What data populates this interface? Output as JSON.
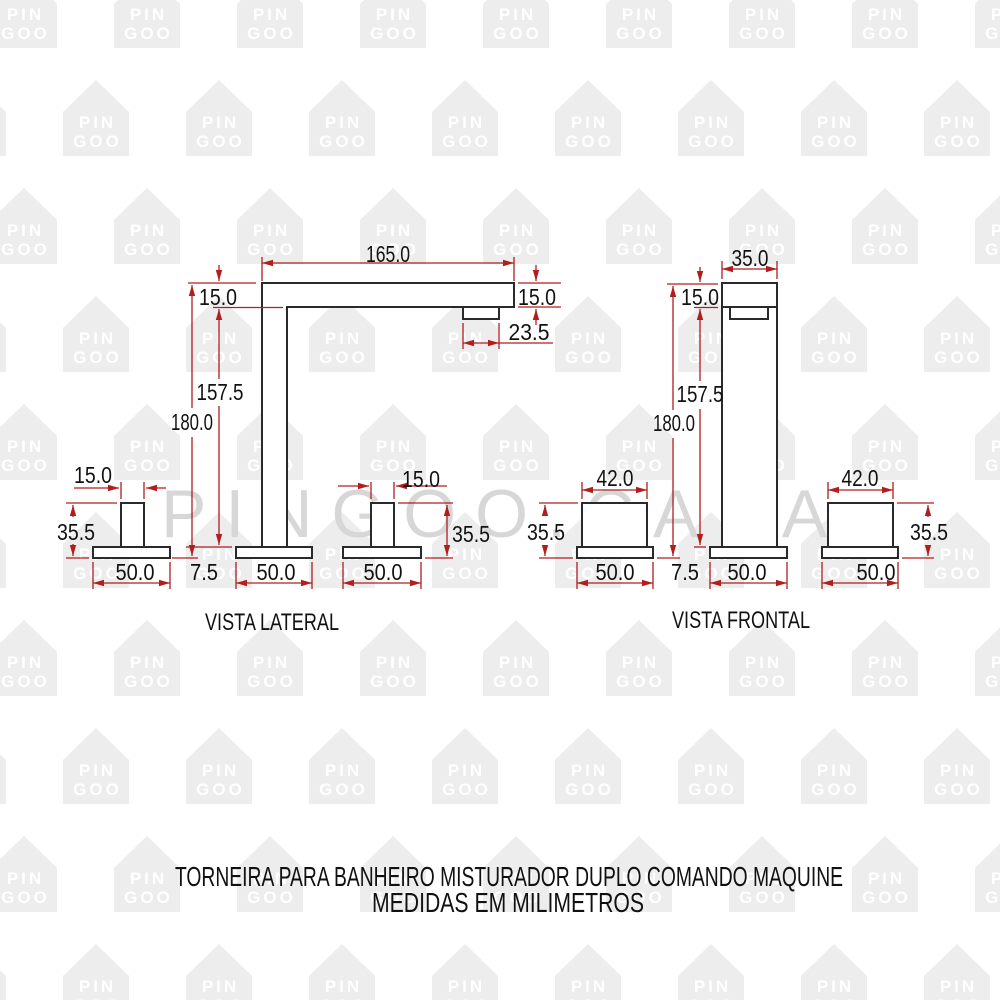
{
  "watermark": {
    "brand_text": "PINGOO.CASA",
    "brand_color": "#d7d7d7",
    "house_line1": "PIN",
    "house_line2": "GOO",
    "house_fill": "#ededed",
    "house_text_color": "#ffffff"
  },
  "drawing": {
    "colors": {
      "outline": "#2a2a2a",
      "dimension": "#b01e1e",
      "text": "#111111"
    },
    "side_view": {
      "label": "VISTA LATERAL",
      "spout_length": "165.0",
      "spout_thickness": "15.0",
      "spout_thickness_right": "15.0",
      "aerator_length": "23.5",
      "height_under_spout": "157.5",
      "total_height": "180.0",
      "base_plate_thickness": "7.5",
      "left_handle_width": "15.0",
      "right_handle_width": "15.0",
      "left_handle_height": "35.5",
      "right_handle_height": "35.5",
      "left_base_width": "50.0",
      "center_base_width": "50.0",
      "right_base_width": "50.0"
    },
    "front_view": {
      "label": "VISTA FRONTAL",
      "body_width": "35.0",
      "cap_height": "15.0",
      "height_under_cap": "157.5",
      "total_height": "180.0",
      "base_plate_thickness": "7.5",
      "left_handle_width": "42.0",
      "right_handle_width": "42.0",
      "left_handle_height": "35.5",
      "right_handle_height": "35.5",
      "left_base_width": "50.0",
      "center_base_width": "50.0",
      "right_base_width": "50.0"
    }
  },
  "footer": {
    "line1": "TORNEIRA PARA BANHEIRO MISTURADOR DUPLO COMANDO MAQUINE",
    "line2": "MEDIDAS EM MILIMETROS"
  }
}
